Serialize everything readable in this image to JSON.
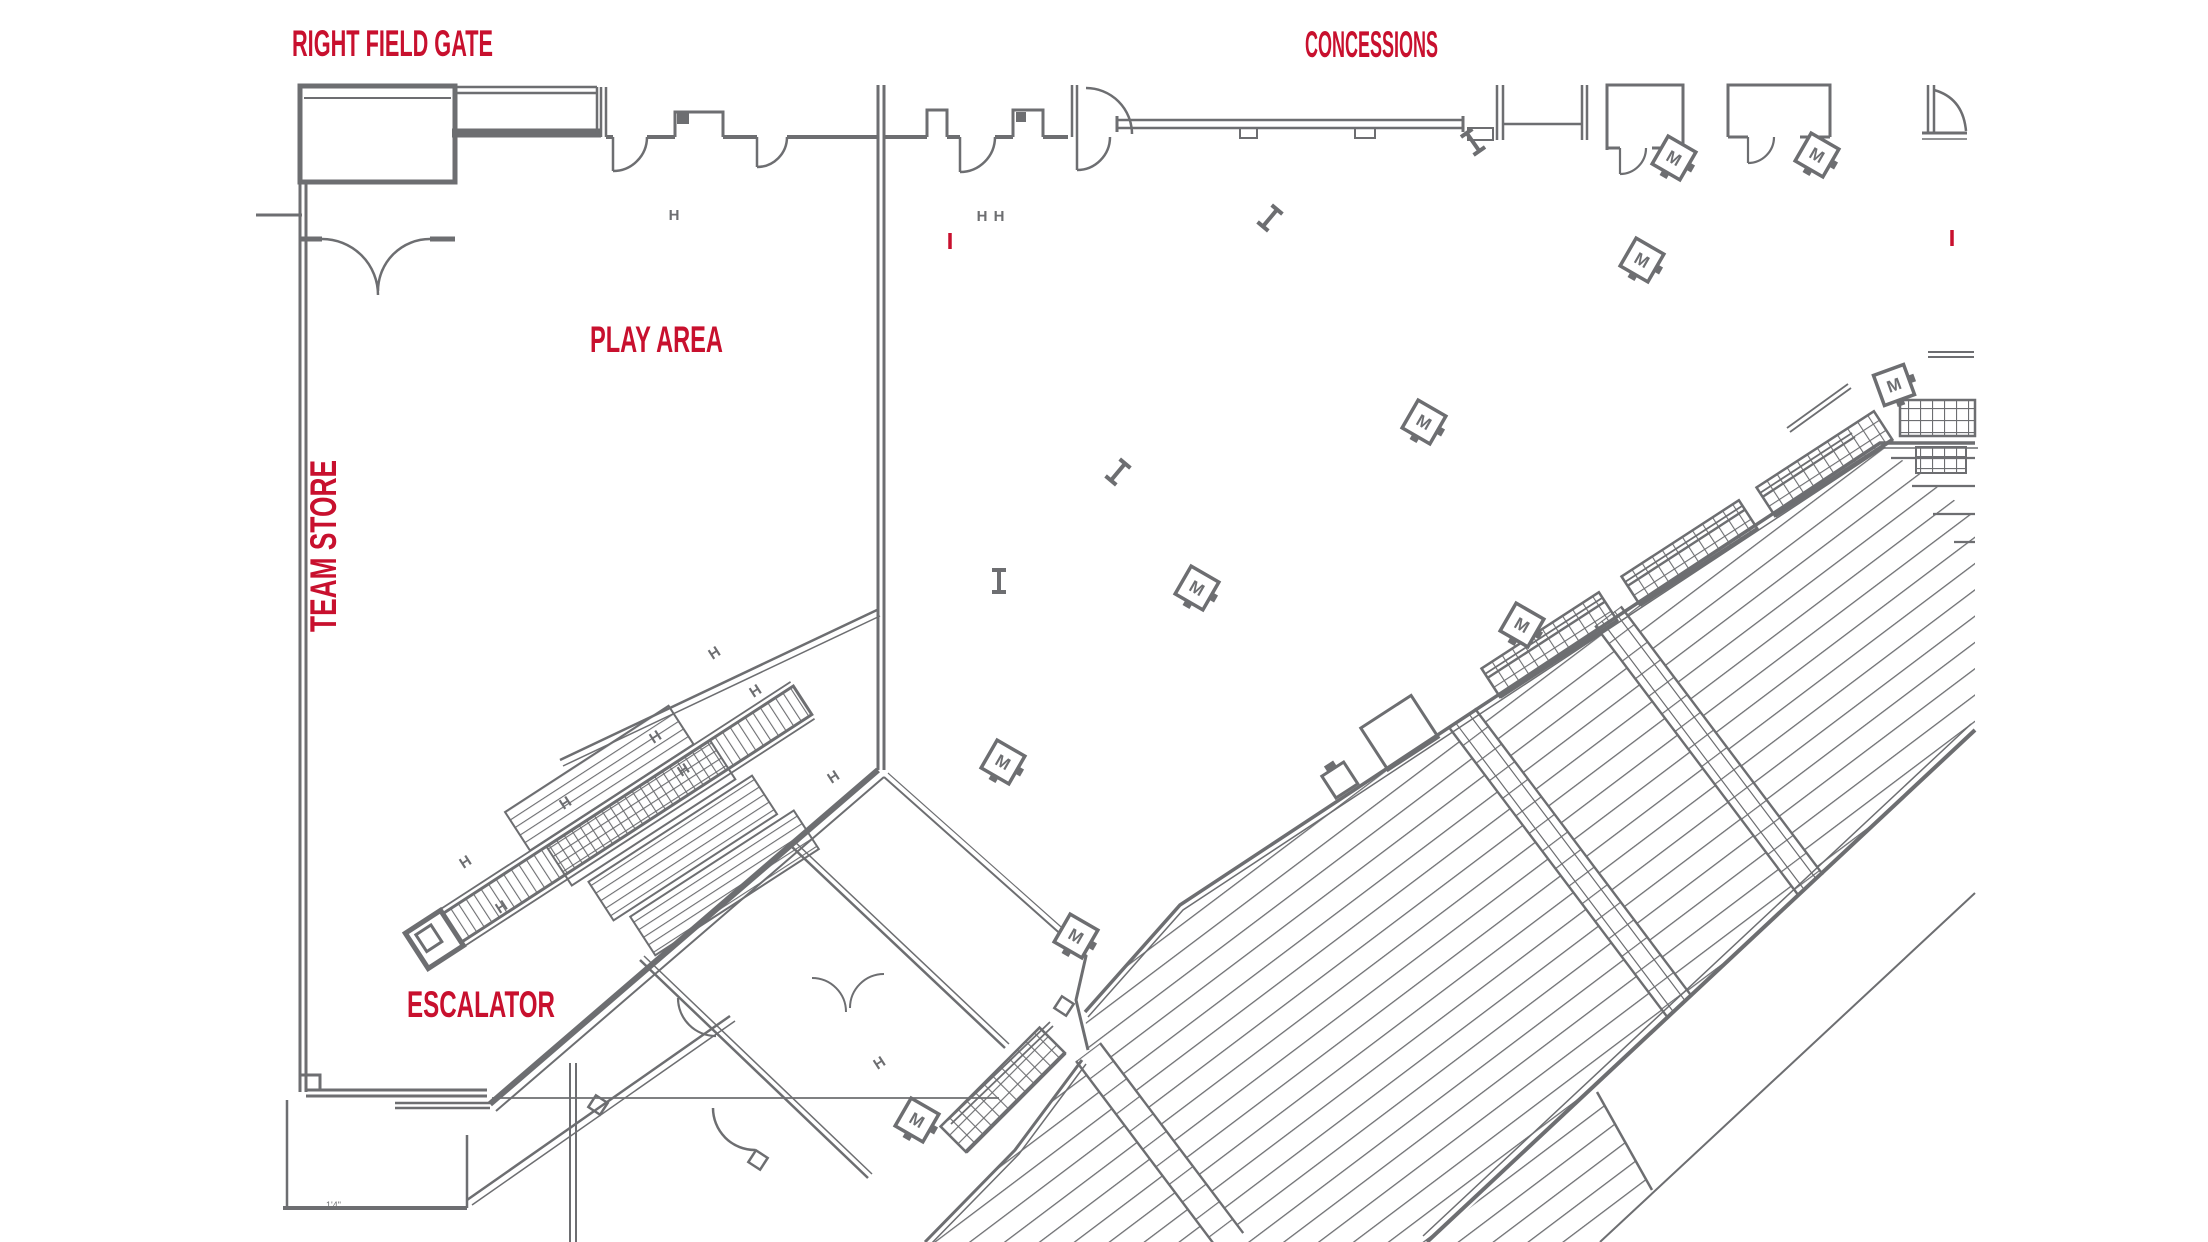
{
  "map": {
    "labels": {
      "right_field_gate": "RIGHT FIELD GATE",
      "concessions": "CONCESSIONS",
      "play_area": "PLAY AREA",
      "team_store": "TEAM STORE",
      "escalator": "ESCALATOR",
      "dimension_note": "1'4\""
    },
    "colors": {
      "label_red": "#C8102E",
      "line_gray": "#6D6E71",
      "background": "#FFFFFF"
    },
    "markers": {
      "kiosk_letter": "M",
      "column_letter": "H",
      "kiosks": [
        [
          1817,
          155,
          30
        ],
        [
          1674,
          158,
          30
        ],
        [
          1642,
          260,
          30
        ],
        [
          1424,
          422,
          30
        ],
        [
          1894,
          385,
          -20
        ],
        [
          1197,
          588,
          30
        ],
        [
          1522,
          625,
          30
        ],
        [
          1003,
          762,
          30
        ],
        [
          1076,
          936,
          30
        ],
        [
          917,
          1120,
          30
        ]
      ],
      "columns_h": [
        [
          674,
          220,
          0
        ],
        [
          982,
          221,
          0
        ],
        [
          999,
          221,
          0
        ],
        [
          717,
          657,
          -33
        ],
        [
          758,
          695,
          -33
        ],
        [
          658,
          741,
          -33
        ],
        [
          686,
          774,
          -33
        ],
        [
          836,
          781,
          -33
        ],
        [
          568,
          807,
          -33
        ],
        [
          468,
          866,
          -33
        ],
        [
          504,
          911,
          -33
        ],
        [
          882,
          1067,
          -33
        ]
      ],
      "columns_i": [
        [
          1270,
          218,
          40
        ],
        [
          1473,
          142,
          -35
        ],
        [
          1118,
          472,
          40
        ],
        [
          999,
          581,
          0
        ]
      ],
      "red_ticks": [
        [
          950,
          241
        ],
        [
          1952,
          238
        ]
      ]
    }
  }
}
